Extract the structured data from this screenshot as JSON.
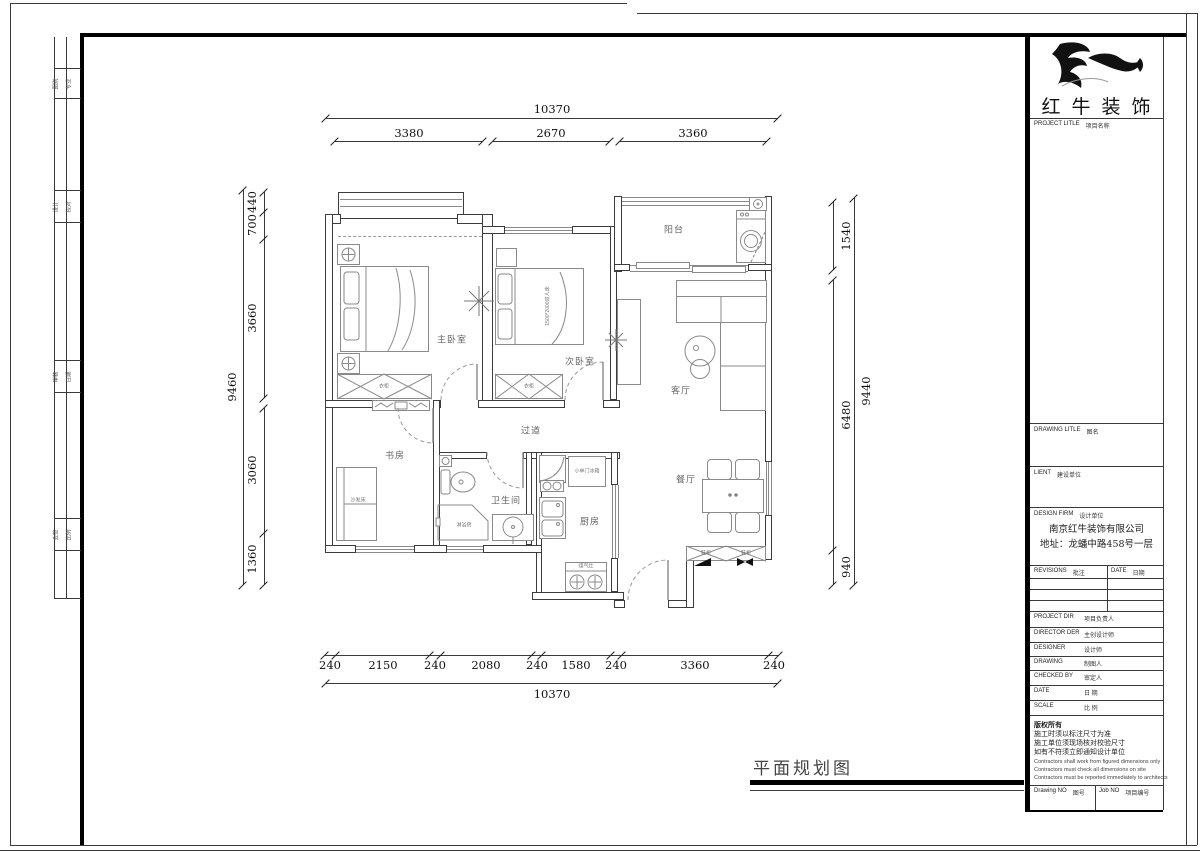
{
  "page": {
    "plan_title": "平面规划图",
    "company": "红牛装饰"
  },
  "dims": {
    "top_total": "10370",
    "top": [
      "3380",
      "2670",
      "3360"
    ],
    "bottom": [
      "240",
      "2150",
      "240",
      "2080",
      "240",
      "1580",
      "240",
      "3360",
      "240"
    ],
    "bottom_total": "10370",
    "left": [
      "440",
      "700",
      "3660",
      "3060",
      "1360"
    ],
    "left_total": "9460",
    "right": [
      "1540",
      "6480",
      "940"
    ],
    "right_total": "9440"
  },
  "rooms": {
    "master": "主卧室",
    "second": "次卧室",
    "living": "客厅",
    "dining": "餐厅",
    "balcony": "阳台",
    "study": "书房",
    "bath": "卫生间",
    "kitchen": "厨房",
    "corridor": "过道"
  },
  "furniture": {
    "wardrobe1": "衣柜",
    "wardrobe2": "衣柜",
    "bed2": "1500*2000双人床",
    "fridge": "小单门冰箱",
    "stove": "煤气灶",
    "shower": "淋浴房",
    "sofa_bed": "沙发床",
    "shoe1": "鞋柜",
    "shoe2": "鞋柜"
  },
  "titleblock": {
    "company": "红牛装饰",
    "project": {
      "en": "PROJECT LITLE",
      "cn": "项目名称"
    },
    "drawing": {
      "en": "DRAWING LITLE",
      "cn": "图名"
    },
    "client": {
      "en": "LIENT",
      "cn": "建设单位"
    },
    "firm": {
      "en": "DESIGN FIRM",
      "cn": "设计单位"
    },
    "firm_name": "南京红牛装饰有限公司",
    "firm_addr": "地址：龙蟠中路458号一层",
    "revisions": {
      "en": "REVISIONS",
      "cn": "批注"
    },
    "date_col": {
      "en": "DATE",
      "cn": "日期"
    },
    "staff": [
      {
        "en": "PROJECT DIR",
        "cn": "项目负责人"
      },
      {
        "en": "DIRECTOR DER",
        "cn": "主创设计师"
      },
      {
        "en": "DESIGNER",
        "cn": "设计师"
      },
      {
        "en": "DRAWING",
        "cn": "制图人"
      },
      {
        "en": "CHECKED BY",
        "cn": "审定人"
      },
      {
        "en": "DATE",
        "cn": "日  期"
      },
      {
        "en": "SCALE",
        "cn": "比  例"
      }
    ],
    "notes_cn": [
      "版权所有",
      "施工时须以标注尺寸为准",
      "施工单位须现场核对校验尺寸",
      "如有不符须立即通知设计单位"
    ],
    "notes_en": [
      "Contractors shall work from figured dimensions only",
      "Contractors must check all dimensions on site",
      "Contractors must be reported immediately to architects"
    ],
    "drawing_no": {
      "en": "Drawing NO",
      "cn": "图号"
    },
    "job_no": {
      "en": "Job NO",
      "cn": "项目编号"
    }
  },
  "edge_strip": [
    [
      "图别",
      "专业"
    ],
    [
      "设计",
      "校对"
    ],
    [
      "审核",
      "日期"
    ],
    [
      "会签",
      "比例"
    ]
  ]
}
